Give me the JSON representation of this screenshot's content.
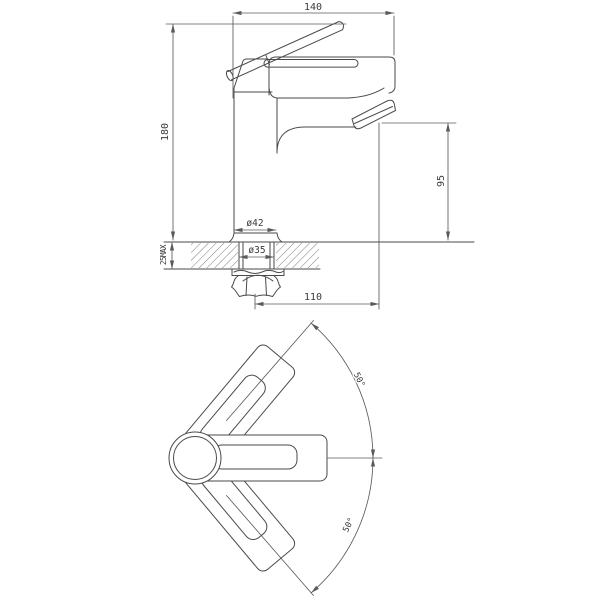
{
  "drawing": {
    "type": "technical-dimension-drawing",
    "subject": "single-lever basin mixer faucet, side elevation and plan view with handle swing arc",
    "views": {
      "side_view": {
        "dims": {
          "top_width": "140",
          "overall_height": "180",
          "spout_height": "95",
          "body_diameter": "ø42",
          "mounting_hole_diameter": "ø35",
          "deck_thickness_max": "25MAX",
          "spout_reach": "110"
        }
      },
      "top_view": {
        "dims": {
          "handle_swing_upper": "50°",
          "handle_swing_lower": "50°"
        }
      }
    },
    "colors": {
      "line": "#4a4a4a",
      "dimension": "#5b5b5b",
      "text": "#3a3a3a",
      "hatch": "#707070",
      "background": "#ffffff"
    }
  }
}
